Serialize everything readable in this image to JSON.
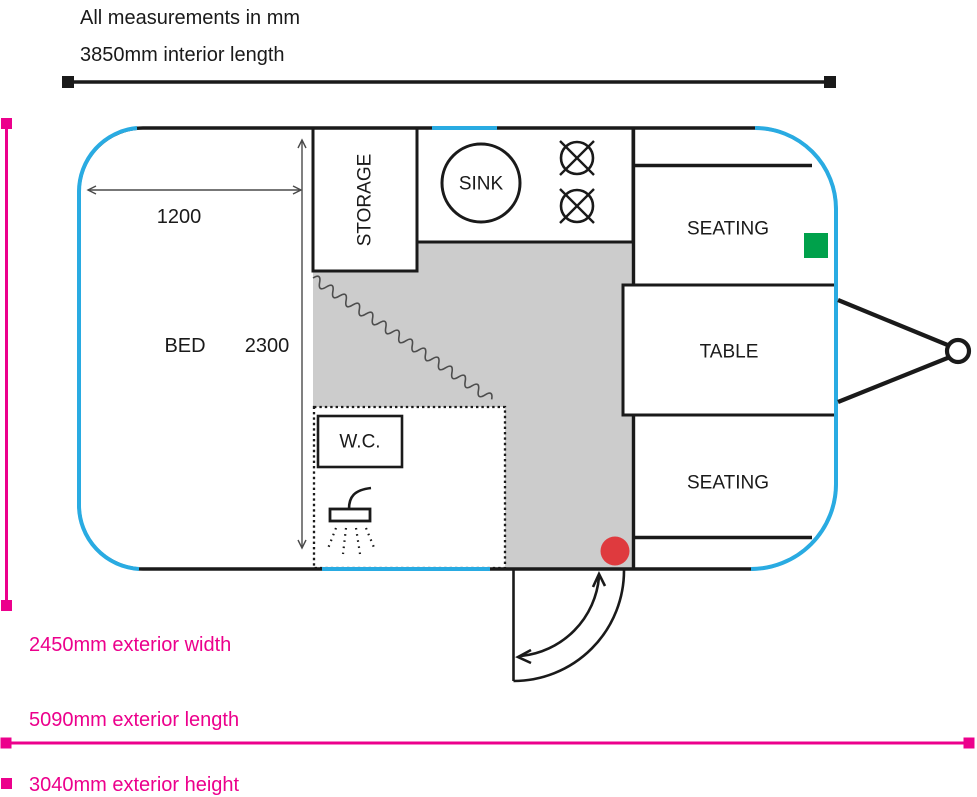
{
  "header": {
    "measurements_note": "All measurements in mm",
    "interior_length_label": "3850mm interior length"
  },
  "rooms": {
    "bed": "BED",
    "storage": "STORAGE",
    "sink": "SINK",
    "wc": "W.C.",
    "seating_front": "SEATING",
    "table": "TABLE",
    "seating_rear": "SEATING"
  },
  "interior_dimensions": {
    "bed_width_mm": "1200",
    "bed_length_mm": "2300"
  },
  "exterior_dimensions": {
    "width_label": "2450mm exterior width",
    "length_label": "5090mm exterior length",
    "height_label": "3040mm exterior height"
  },
  "colors": {
    "outline_cyan": "#29ABE2",
    "dimension_pink": "#EC008C",
    "marker_green": "#00A14B",
    "marker_red": "#DF3A3E",
    "floor_gray": "#CCCCCC",
    "ink_black": "#1A1A1A"
  }
}
